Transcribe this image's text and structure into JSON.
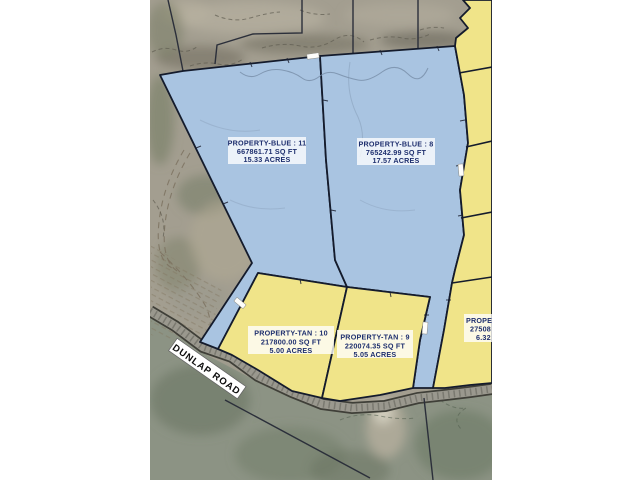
{
  "map": {
    "road_label": "DUNLAP ROAD",
    "parcels": [
      {
        "id": "blue-11",
        "name": "PROPERTY-BLUE : 11",
        "sqft": "667861.71 SQ FT",
        "acres": "15.33 ACRES",
        "color": "blue"
      },
      {
        "id": "blue-8",
        "name": "PROPERTY-BLUE : 8",
        "sqft": "765242.99 SQ FT",
        "acres": "17.57 ACRES",
        "color": "blue"
      },
      {
        "id": "tan-10",
        "name": "PROPERTY-TAN : 10",
        "sqft": "217800.00 SQ FT",
        "acres": "5.00 ACRES",
        "color": "tan"
      },
      {
        "id": "tan-9",
        "name": "PROPERTY-TAN : 9",
        "sqft": "220074.35 SQ FT",
        "acres": "5.05 ACRES",
        "color": "tan"
      },
      {
        "id": "tan-edge-clipped",
        "name": "PROPE",
        "sqft": "27508",
        "acres": "6.32",
        "color": "tan",
        "clipped_at_right_edge": true
      }
    ],
    "colors": {
      "parcel_blue": "#a9c4e1",
      "parcel_tan": "#f0e489",
      "parcel_outline": "#141b2c",
      "label_text": "#1e2f6e",
      "road_fill": "#9a988e",
      "aerial_top": "#a39e90",
      "aerial_below_road": "#8c9384",
      "page_margin": "#ffffff"
    }
  }
}
